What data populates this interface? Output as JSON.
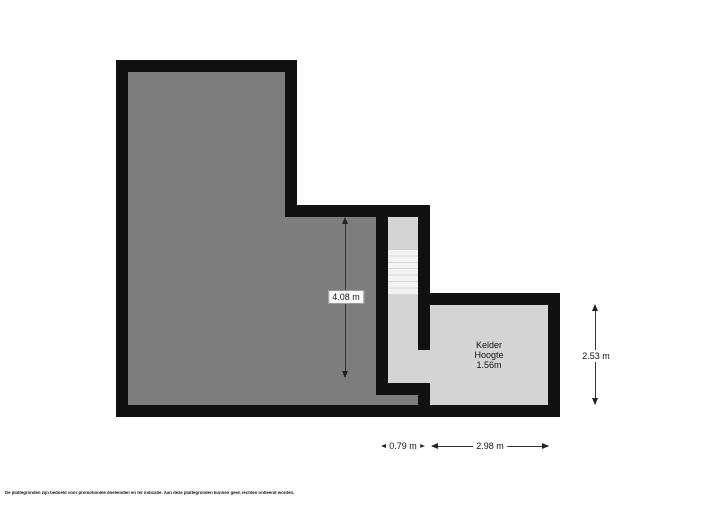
{
  "floorplan": {
    "rooms": {
      "kelder": {
        "name": "Kelder",
        "height_line1": "Hoogte",
        "height_line2": "1.56m"
      }
    },
    "dimensions": {
      "main_room_height": "4.08 m",
      "kelder_height": "2.53 m",
      "stair_width": "0.79 m",
      "kelder_width": "2.98 m"
    },
    "colors": {
      "wall": "#111111",
      "floor_dark": "#7d7d7d",
      "floor_light": "#d4d4d4",
      "stairs": "#f2f2f2"
    },
    "stairs_tread_count": 7
  },
  "footer": {
    "disclaimer": "De plattegronden zijn bedoeld voor promotionele doeleinden en ter indicatie. Aan deze plattegronden kunnen geen rechten ontleend worden."
  }
}
